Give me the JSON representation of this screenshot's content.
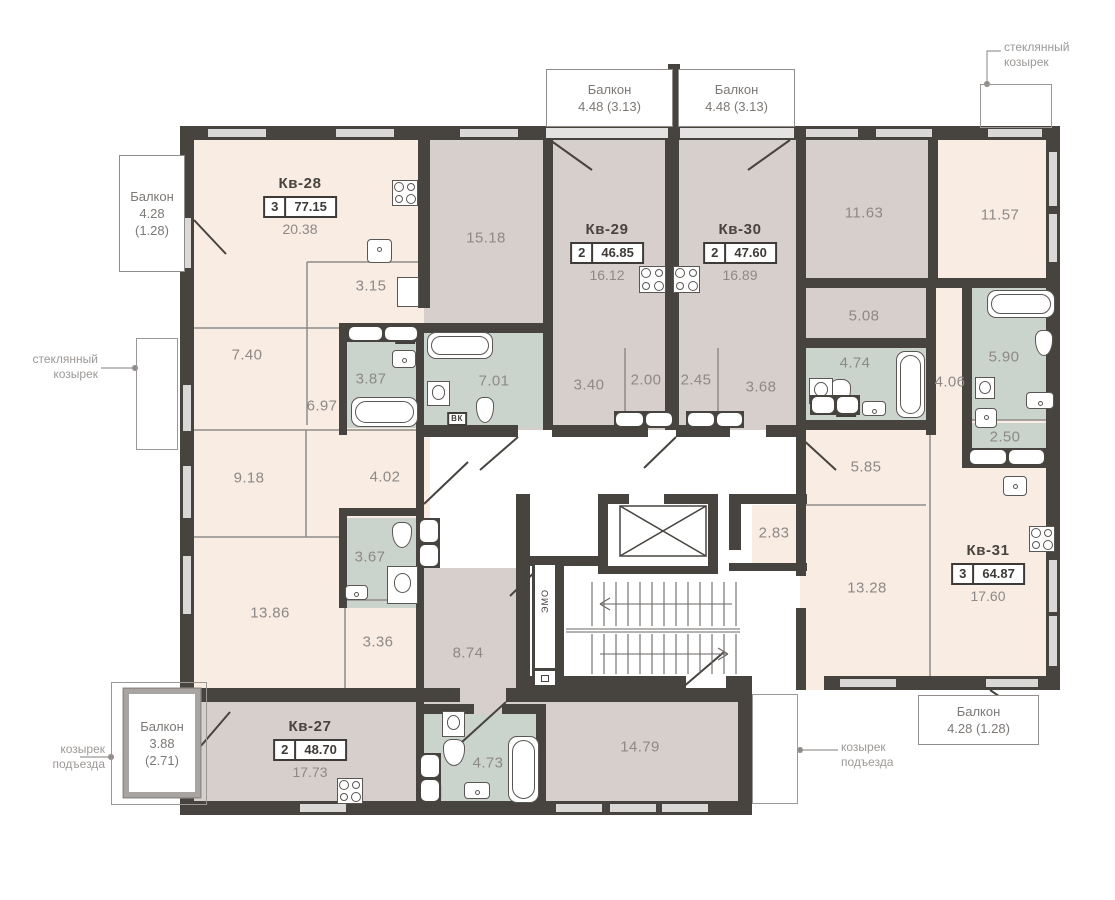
{
  "plan_title": "Этажный план — квартиры Кв-27…Кв-31",
  "colors": {
    "wall": "#47433f",
    "room_cream": "#f9ece3",
    "room_mauve": "#d7cfcc",
    "room_sage": "#cbd3cd",
    "corridor_white": "#ffffff",
    "window_light": "#dbd9d8",
    "area_text": "#8d8987",
    "annotation_text": "#9c9896"
  },
  "apartments": [
    {
      "name": "Кв-28",
      "rooms": "3",
      "total": "77.15",
      "kitchen": "20.38",
      "x": 300,
      "y": 175
    },
    {
      "name": "Кв-29",
      "rooms": "2",
      "total": "46.85",
      "kitchen": "16.12",
      "x": 607,
      "y": 221
    },
    {
      "name": "Кв-30",
      "rooms": "2",
      "total": "47.60",
      "kitchen": "16.89",
      "x": 740,
      "y": 221
    },
    {
      "name": "Кв-31",
      "rooms": "3",
      "total": "64.87",
      "kitchen": "17.60",
      "x": 988,
      "y": 542
    },
    {
      "name": "Кв-27",
      "rooms": "2",
      "total": "48.70",
      "kitchen": "17.73",
      "x": 310,
      "y": 718
    }
  ],
  "rooms": [
    {
      "area": "15.18",
      "x": 486,
      "y": 238
    },
    {
      "area": "3.15",
      "x": 371,
      "y": 286
    },
    {
      "area": "7.40",
      "x": 247,
      "y": 355
    },
    {
      "area": "3.87",
      "x": 371,
      "y": 379
    },
    {
      "area": "6.97",
      "x": 322,
      "y": 406
    },
    {
      "area": "7.01",
      "x": 494,
      "y": 381
    },
    {
      "area": "3.40",
      "x": 589,
      "y": 385
    },
    {
      "area": "2.00",
      "x": 646,
      "y": 380
    },
    {
      "area": "2.45",
      "x": 696,
      "y": 380
    },
    {
      "area": "3.68",
      "x": 761,
      "y": 387
    },
    {
      "area": "11.63",
      "x": 864,
      "y": 213
    },
    {
      "area": "11.57",
      "x": 1000,
      "y": 215
    },
    {
      "area": "5.08",
      "x": 864,
      "y": 316
    },
    {
      "area": "4.74",
      "x": 855,
      "y": 363
    },
    {
      "area": "4.06",
      "x": 950,
      "y": 382
    },
    {
      "area": "5.90",
      "x": 1004,
      "y": 357
    },
    {
      "area": "2.50",
      "x": 1005,
      "y": 437
    },
    {
      "area": "9.18",
      "x": 249,
      "y": 478
    },
    {
      "area": "4.02",
      "x": 385,
      "y": 477
    },
    {
      "area": "3.67",
      "x": 370,
      "y": 557
    },
    {
      "area": "13.86",
      "x": 270,
      "y": 613
    },
    {
      "area": "3.36",
      "x": 378,
      "y": 642
    },
    {
      "area": "8.74",
      "x": 468,
      "y": 653
    },
    {
      "area": "5.85",
      "x": 866,
      "y": 467
    },
    {
      "area": "2.83",
      "x": 774,
      "y": 533
    },
    {
      "area": "13.28",
      "x": 867,
      "y": 588
    },
    {
      "area": "14.79",
      "x": 640,
      "y": 747
    },
    {
      "area": "4.73",
      "x": 488,
      "y": 763
    }
  ],
  "balconies": [
    {
      "lines": "Балкон\n4.48 (3.13)",
      "x": 546,
      "y": 69,
      "w": 127,
      "h": 58,
      "thick": false
    },
    {
      "lines": "Балкон\n4.48 (3.13)",
      "x": 678,
      "y": 69,
      "w": 117,
      "h": 58,
      "thick": false
    },
    {
      "lines": "Балкон\n4.28\n(1.28)",
      "x": 119,
      "y": 155,
      "w": 66,
      "h": 117,
      "thick": false
    },
    {
      "lines": "Балкон\n3.88\n(2.71)",
      "x": 124,
      "y": 689,
      "w": 76,
      "h": 108,
      "thick": true
    },
    {
      "lines": "Балкон\n4.28 (1.28)",
      "x": 918,
      "y": 695,
      "w": 121,
      "h": 50,
      "thick": false
    }
  ],
  "canopies": [
    {
      "x": 980,
      "y": 84,
      "w": 72,
      "h": 44
    },
    {
      "x": 136,
      "y": 338,
      "w": 42,
      "h": 112
    },
    {
      "x": 752,
      "y": 694,
      "w": 46,
      "h": 110
    },
    {
      "x": 111,
      "y": 682,
      "w": 96,
      "h": 123
    }
  ],
  "annotations": [
    {
      "lines": "стеклянный\nкозырек",
      "x": 1004,
      "y": 40,
      "align": "left"
    },
    {
      "lines": "стеклянный\nкозырек",
      "x": 98,
      "y": 352,
      "align": "right"
    },
    {
      "lines": "козырек\nподъезда",
      "x": 105,
      "y": 742,
      "align": "right"
    },
    {
      "lines": "козырек\nподъезда",
      "x": 841,
      "y": 740,
      "align": "left"
    }
  ],
  "vk_badges": [
    {
      "label": "ВК",
      "x": 405,
      "y": 337
    },
    {
      "label": "ВК",
      "x": 457,
      "y": 419
    },
    {
      "label": "ВК",
      "x": 657,
      "y": 420
    },
    {
      "label": "ВК",
      "x": 846,
      "y": 410
    },
    {
      "label": "ВК",
      "x": 429,
      "y": 536
    },
    {
      "label": "ВК",
      "x": 431,
      "y": 792
    }
  ],
  "fixtures": [
    {
      "t": "stove",
      "x": 392,
      "y": 180,
      "w": 26,
      "h": 26
    },
    {
      "t": "stove",
      "x": 639,
      "y": 266,
      "w": 27,
      "h": 27
    },
    {
      "t": "stove",
      "x": 673,
      "y": 266,
      "w": 27,
      "h": 27
    },
    {
      "t": "stove",
      "x": 1029,
      "y": 526,
      "w": 26,
      "h": 26
    },
    {
      "t": "stove",
      "x": 337,
      "y": 778,
      "w": 26,
      "h": 26
    },
    {
      "t": "sink",
      "x": 367,
      "y": 239,
      "w": 25,
      "h": 24
    },
    {
      "t": "sink",
      "x": 1003,
      "y": 476,
      "w": 24,
      "h": 20
    },
    {
      "t": "unit",
      "x": 397,
      "y": 277,
      "w": 22,
      "h": 30
    },
    {
      "t": "tub-h",
      "x": 351,
      "y": 397,
      "w": 67,
      "h": 30
    },
    {
      "t": "tub-h",
      "x": 427,
      "y": 332,
      "w": 66,
      "h": 27
    },
    {
      "t": "tub-v",
      "x": 896,
      "y": 351,
      "w": 29,
      "h": 67
    },
    {
      "t": "tub-h",
      "x": 987,
      "y": 290,
      "w": 68,
      "h": 28
    },
    {
      "t": "tub-v",
      "x": 508,
      "y": 736,
      "w": 31,
      "h": 67
    },
    {
      "t": "toilet",
      "x": 476,
      "y": 397,
      "w": 18,
      "h": 26
    },
    {
      "t": "toilet",
      "x": 830,
      "y": 379,
      "w": 21,
      "h": 27
    },
    {
      "t": "toilet",
      "x": 392,
      "y": 522,
      "w": 20,
      "h": 26
    },
    {
      "t": "toilet",
      "x": 443,
      "y": 739,
      "w": 22,
      "h": 27
    },
    {
      "t": "toilet",
      "x": 1035,
      "y": 330,
      "w": 18,
      "h": 26
    },
    {
      "t": "wm",
      "x": 427,
      "y": 381,
      "w": 23,
      "h": 25
    },
    {
      "t": "wm",
      "x": 809,
      "y": 378,
      "w": 24,
      "h": 26
    },
    {
      "t": "wm",
      "x": 975,
      "y": 377,
      "w": 20,
      "h": 22
    },
    {
      "t": "wm",
      "x": 442,
      "y": 711,
      "w": 23,
      "h": 26
    },
    {
      "t": "bsink",
      "x": 392,
      "y": 350,
      "w": 24,
      "h": 18
    },
    {
      "t": "bsink",
      "x": 345,
      "y": 585,
      "w": 23,
      "h": 15
    },
    {
      "t": "bsink",
      "x": 862,
      "y": 401,
      "w": 24,
      "h": 15
    },
    {
      "t": "bsink",
      "x": 1026,
      "y": 392,
      "w": 28,
      "h": 17
    },
    {
      "t": "bsink",
      "x": 975,
      "y": 408,
      "w": 22,
      "h": 20
    },
    {
      "t": "bsink",
      "x": 464,
      "y": 782,
      "w": 26,
      "h": 17
    },
    {
      "t": "shower",
      "x": 387,
      "y": 566,
      "w": 31,
      "h": 38
    },
    {
      "t": "strip-h",
      "x": 347,
      "y": 325,
      "w": 72,
      "h": 17
    },
    {
      "t": "strip-h",
      "x": 614,
      "y": 411,
      "w": 60,
      "h": 17
    },
    {
      "t": "strip-h",
      "x": 686,
      "y": 411,
      "w": 58,
      "h": 17
    },
    {
      "t": "strip-h",
      "x": 810,
      "y": 395,
      "w": 50,
      "h": 20
    },
    {
      "t": "strip-v",
      "x": 418,
      "y": 518,
      "w": 22,
      "h": 50
    },
    {
      "t": "strip-v",
      "x": 419,
      "y": 753,
      "w": 22,
      "h": 50
    },
    {
      "t": "strip-h",
      "x": 968,
      "y": 448,
      "w": 78,
      "h": 18
    }
  ],
  "labels": {
    "emo": "ЭМО",
    "emo_box": {
      "x": 532,
      "y": 562,
      "w": 26,
      "h": 126
    }
  }
}
